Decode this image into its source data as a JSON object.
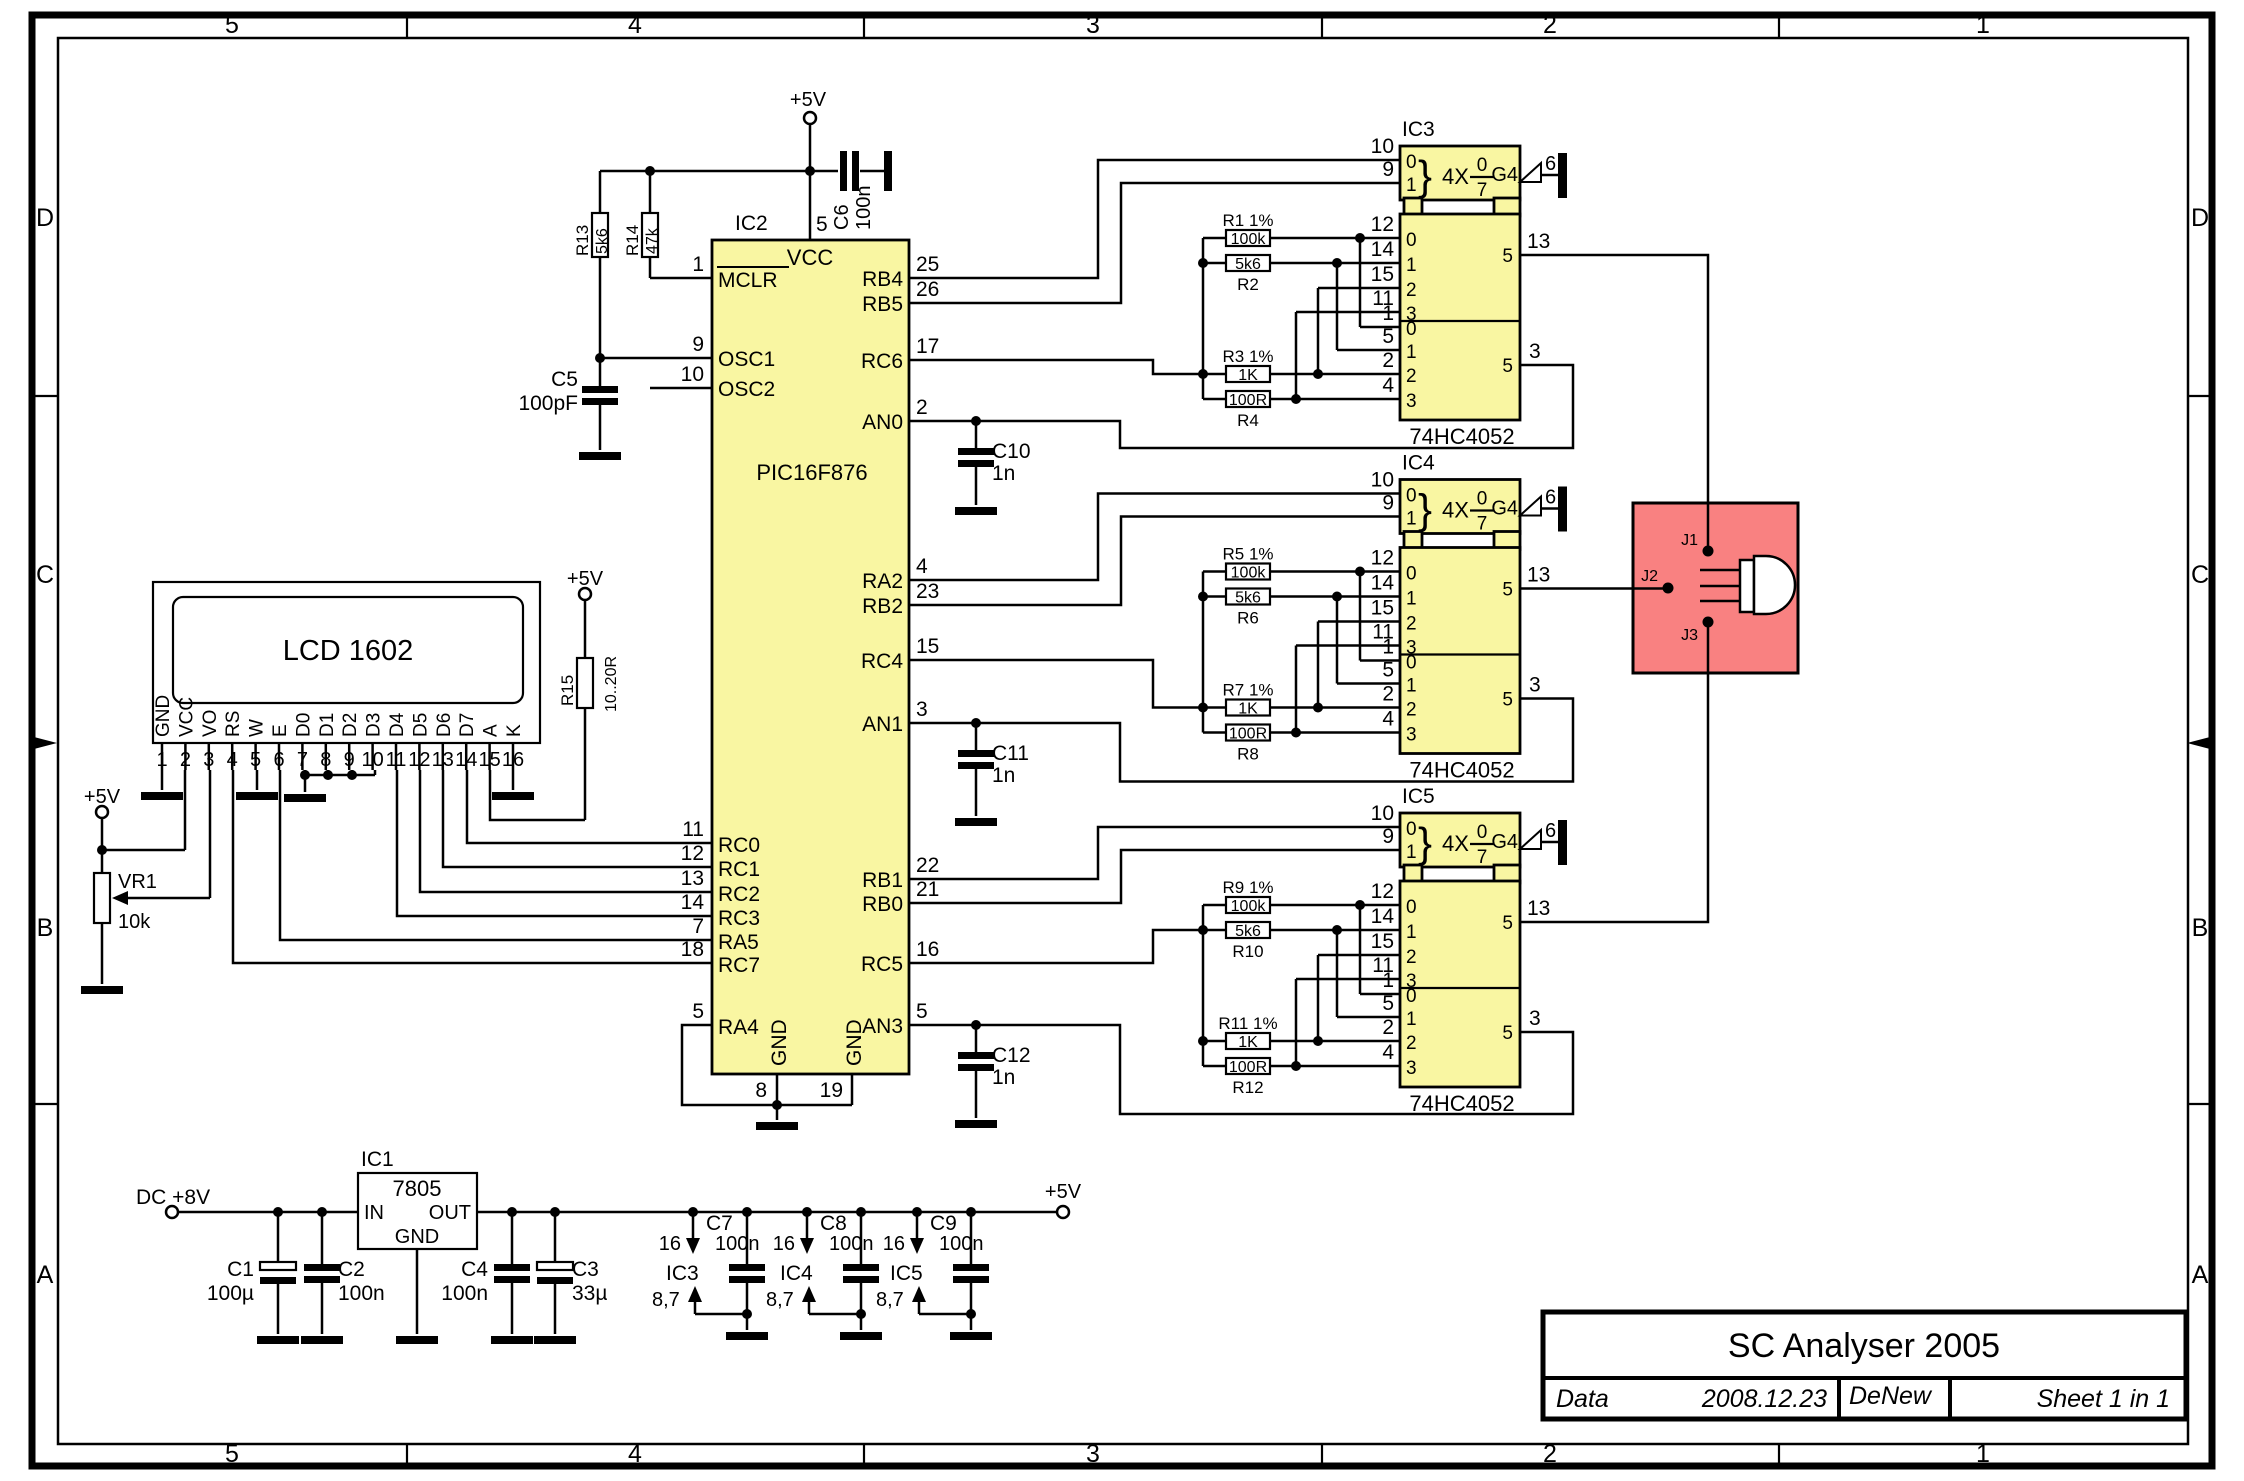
{
  "frame": {
    "column_labels": [
      "5",
      "4",
      "3",
      "2",
      "1"
    ],
    "row_labels": [
      "D",
      "C",
      "B",
      "A"
    ]
  },
  "title_block": {
    "title": "SC Analyser 2005",
    "field_label": "Data",
    "date": "2008.12.23",
    "author": "DeNew",
    "sheet_info": "Sheet  1  in  1"
  },
  "rails": {
    "v5": "+5V"
  },
  "mcu": {
    "ref": "IC2",
    "part": "PIC16F876",
    "vcc_label": "VCC",
    "vcc_pin": "5",
    "gnd_left": {
      "label": "GND",
      "pin": "8"
    },
    "gnd_right": {
      "label": "GND",
      "pin": "19"
    },
    "left_pins": [
      {
        "num": "1",
        "name": "MCLR"
      },
      {
        "num": "9",
        "name": "OSC1"
      },
      {
        "num": "10",
        "name": "OSC2"
      },
      {
        "num": "11",
        "name": "RC0"
      },
      {
        "num": "12",
        "name": "RC1"
      },
      {
        "num": "13",
        "name": "RC2"
      },
      {
        "num": "14",
        "name": "RC3"
      },
      {
        "num": "7",
        "name": "RA5"
      },
      {
        "num": "18",
        "name": "RC7"
      },
      {
        "num": "5",
        "name": "RA4"
      }
    ],
    "right_pins": [
      {
        "num": "25",
        "name": "RB4"
      },
      {
        "num": "26",
        "name": "RB5"
      },
      {
        "num": "17",
        "name": "RC6"
      },
      {
        "num": "2",
        "name": "AN0"
      },
      {
        "num": "4",
        "name": "RA2"
      },
      {
        "num": "23",
        "name": "RB2"
      },
      {
        "num": "15",
        "name": "RC4"
      },
      {
        "num": "3",
        "name": "AN1"
      },
      {
        "num": "22",
        "name": "RB1"
      },
      {
        "num": "21",
        "name": "RB0"
      },
      {
        "num": "16",
        "name": "RC5"
      },
      {
        "num": "5",
        "name": "AN3"
      }
    ]
  },
  "reset_osc": {
    "r13": {
      "ref": "R13",
      "value": "5k6"
    },
    "r14": {
      "ref": "R14",
      "value": "47k"
    },
    "c5": {
      "ref": "C5",
      "value": "100pF"
    },
    "c6": {
      "ref": "C6",
      "value": "100n"
    }
  },
  "adc_filters": [
    {
      "ref": "C10",
      "value": "1n"
    },
    {
      "ref": "C11",
      "value": "1n"
    },
    {
      "ref": "C12",
      "value": "1n"
    }
  ],
  "lcd": {
    "title": "LCD 1602",
    "pins": [
      {
        "num": "1",
        "name": "GND"
      },
      {
        "num": "2",
        "name": "VCC"
      },
      {
        "num": "3",
        "name": "VO"
      },
      {
        "num": "4",
        "name": "RS"
      },
      {
        "num": "5",
        "name": "W"
      },
      {
        "num": "6",
        "name": "E"
      },
      {
        "num": "7",
        "name": "D0"
      },
      {
        "num": "8",
        "name": "D1"
      },
      {
        "num": "9",
        "name": "D2"
      },
      {
        "num": "10",
        "name": "D3"
      },
      {
        "num": "11",
        "name": "D4"
      },
      {
        "num": "12",
        "name": "D5"
      },
      {
        "num": "13",
        "name": "D6"
      },
      {
        "num": "14",
        "name": "D7"
      },
      {
        "num": "15",
        "name": "A"
      },
      {
        "num": "16",
        "name": "K"
      }
    ],
    "backlight_resistor": {
      "ref": "R15",
      "value": "10..20R"
    },
    "contrast_pot": {
      "ref": "VR1",
      "value": "10k"
    }
  },
  "muxes": [
    {
      "ref": "IC3",
      "part": "74HC4052",
      "brace": "}",
      "multi": "4X",
      "frac_top": "0",
      "frac_bot": "7",
      "enable_label": "G4",
      "enable_pin": "6",
      "sel_pin_nums": [
        "10",
        "9"
      ],
      "sel_channels": [
        "0",
        "1"
      ],
      "in_pin_nums": [
        "12",
        "14",
        "15",
        "11"
      ],
      "in2_pin_nums": [
        "1",
        "5",
        "2",
        "4"
      ],
      "channels": [
        "0",
        "1",
        "2",
        "3"
      ],
      "out_top": {
        "com": "5",
        "pin": "13"
      },
      "out_bot": {
        "com": "5",
        "pin": "3"
      },
      "resistors": [
        {
          "label": "R1 1%",
          "value": "100k"
        },
        {
          "label": "R2",
          "value": "5k6"
        },
        {
          "label": "R3  1%",
          "value": "1K"
        },
        {
          "label": "R4",
          "value": "100R"
        }
      ]
    },
    {
      "ref": "IC4",
      "part": "74HC4052",
      "brace": "}",
      "multi": "4X",
      "frac_top": "0",
      "frac_bot": "7",
      "enable_label": "G4",
      "enable_pin": "6",
      "sel_pin_nums": [
        "10",
        "9"
      ],
      "sel_channels": [
        "0",
        "1"
      ],
      "in_pin_nums": [
        "12",
        "14",
        "15",
        "11"
      ],
      "in2_pin_nums": [
        "1",
        "5",
        "2",
        "4"
      ],
      "channels": [
        "0",
        "1",
        "2",
        "3"
      ],
      "out_top": {
        "com": "5",
        "pin": "13"
      },
      "out_bot": {
        "com": "5",
        "pin": "3"
      },
      "resistors": [
        {
          "label": "R5 1%",
          "value": "100k"
        },
        {
          "label": "R6",
          "value": "5k6"
        },
        {
          "label": "R7  1%",
          "value": "1K"
        },
        {
          "label": "R8",
          "value": "100R"
        }
      ]
    },
    {
      "ref": "IC5",
      "part": "74HC4052",
      "brace": "}",
      "multi": "4X",
      "frac_top": "0",
      "frac_bot": "7",
      "enable_label": "G4",
      "enable_pin": "6",
      "sel_pin_nums": [
        "10",
        "9"
      ],
      "sel_channels": [
        "0",
        "1"
      ],
      "in_pin_nums": [
        "12",
        "14",
        "15",
        "11"
      ],
      "in2_pin_nums": [
        "1",
        "5",
        "2",
        "4"
      ],
      "channels": [
        "0",
        "1",
        "2",
        "3"
      ],
      "out_top": {
        "com": "5",
        "pin": "13"
      },
      "out_bot": {
        "com": "5",
        "pin": "3"
      },
      "resistors": [
        {
          "label": "R9  1%",
          "value": "100k"
        },
        {
          "label": "R10",
          "value": "5k6"
        },
        {
          "label": "R11  1%",
          "value": "1K"
        },
        {
          "label": "R12",
          "value": "100R"
        }
      ]
    }
  ],
  "dut": {
    "jacks": [
      "J1",
      "J2",
      "J3"
    ]
  },
  "power_supply": {
    "input_label": "DC +8V",
    "rail_label": "+5V",
    "regulator": {
      "ref": "IC1",
      "part": "7805",
      "in": "IN",
      "out": "OUT",
      "gnd": "GND"
    },
    "caps": [
      {
        "ref": "C1",
        "value": "100µ"
      },
      {
        "ref": "C2",
        "value": "100n"
      },
      {
        "ref": "C4",
        "value": "100n"
      },
      {
        "ref": "C3",
        "value": "33µ"
      }
    ],
    "decoupling": [
      {
        "ref": "C7",
        "value": "100n",
        "ic": "IC3",
        "vcc_pin": "16",
        "gnd_pins": "8,7"
      },
      {
        "ref": "C8",
        "value": "100n",
        "ic": "IC4",
        "vcc_pin": "16",
        "gnd_pins": "8,7"
      },
      {
        "ref": "C9",
        "value": "100n",
        "ic": "IC5",
        "vcc_pin": "16",
        "gnd_pins": "8,7"
      }
    ]
  }
}
